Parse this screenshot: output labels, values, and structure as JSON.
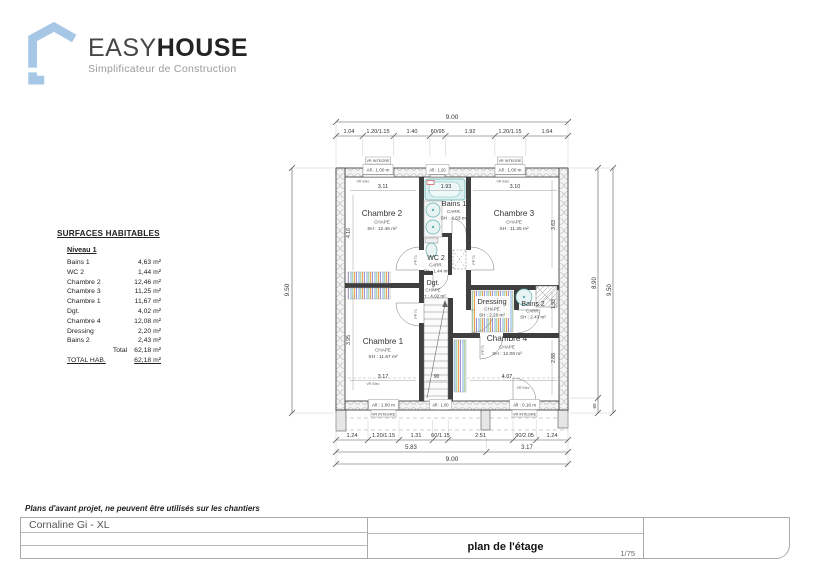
{
  "logo": {
    "brand_light": "EASY",
    "brand_bold": "HOUSE",
    "tagline": "Simplificateur de Construction"
  },
  "surfaces": {
    "title": "SURFACES HABITABLES",
    "level": "Niveau 1",
    "rows": [
      {
        "label": "Bains 1",
        "value": "4,63 m²"
      },
      {
        "label": "WC 2",
        "value": "1,44 m²"
      },
      {
        "label": "Chambre 2",
        "value": "12,46 m²"
      },
      {
        "label": "Chambre 3",
        "value": "11,25 m²"
      },
      {
        "label": "Chambre 1",
        "value": "11,67 m²"
      },
      {
        "label": "Dgt.",
        "value": "4,02 m²"
      },
      {
        "label": "Chambre 4",
        "value": "12,08 m²"
      },
      {
        "label": "Dressing",
        "value": "2,20 m²"
      },
      {
        "label": "Bains 2",
        "value": "2,43 m²"
      }
    ],
    "total_label": "Total",
    "total_value": "62,18 m²",
    "total_hab_label": "TOTAL HAB.",
    "total_hab_value": "62,18 m²"
  },
  "plan": {
    "rooms": {
      "chambre2": {
        "name": "Chambre 2",
        "floor": "CHAPE",
        "area": "SH : 12.46 m²"
      },
      "bains1": {
        "name": "Bains 1",
        "floor": "CARR.",
        "area": "SH : 4.63 m²"
      },
      "chambre3": {
        "name": "Chambre 3",
        "floor": "CHAPE",
        "area": "SH : 11.25 m²"
      },
      "wc2": {
        "name": "WC 2",
        "floor": "CARR.",
        "area": "SH : 1.44 m²"
      },
      "dgt": {
        "name": "Dgt.",
        "floor": "CHAPE",
        "area": "SH : 4.02 m²"
      },
      "dressing": {
        "name": "Dressing",
        "floor": "CHAPE",
        "area": "SH : 2.20 m²"
      },
      "bains2": {
        "name": "Bains 2",
        "floor": "CARR.",
        "area": "SH : 2.43 m²"
      },
      "chambre1": {
        "name": "Chambre 1",
        "floor": "CHAPE",
        "area": "SH : 11.67 m²"
      },
      "chambre4": {
        "name": "Chambre 4",
        "floor": "CHAPE",
        "area": "SH : 12.08 m²"
      }
    },
    "dims": {
      "top_overall": "9.00",
      "top": [
        "1.04",
        "1.20/1.15",
        "1.40",
        "60/95",
        "1.92",
        "1.20/1.15",
        "1.64"
      ],
      "bottom": [
        "1.24",
        "1.20/1.15",
        "1.31",
        "60/1.15",
        "2.51",
        "90/2.05",
        "1.24"
      ],
      "bottom_sub": [
        "5.83",
        "3.17"
      ],
      "bottom_overall": "9.00",
      "left_overall": "9.50",
      "right_inner": "8.90",
      "right_outer": "9.50",
      "right_base": "60",
      "ch2_w": "3.11",
      "bath_w": "1.93",
      "ch3_w": "3.10",
      "ch1_w": "3.17",
      "stair_w": "90",
      "stair_wall": "7",
      "ch4_w": "4.07",
      "ch2_h": "4.16",
      "ch1_h": "3.95",
      "ch3_h": "3.63",
      "bains2_h": "1.53",
      "ch4_h": "2.88"
    },
    "labels": {
      "vr_integre": "VR INTEGRE",
      "all_100m": "All : 1.00 m",
      "all_120": "All : 1.20",
      "all_100": "All : 1.00",
      "all_016m": "All : 0.16 m",
      "vr_elec": "VR Elec",
      "door": "PP.73"
    }
  },
  "footer": {
    "disclaimer": "Plans d'avant projet, ne peuvent être utilisés sur les chantiers",
    "project_name": "Cornaline Gi - XL",
    "drawing_title": "plan de l'étage",
    "scale": "1/75"
  }
}
